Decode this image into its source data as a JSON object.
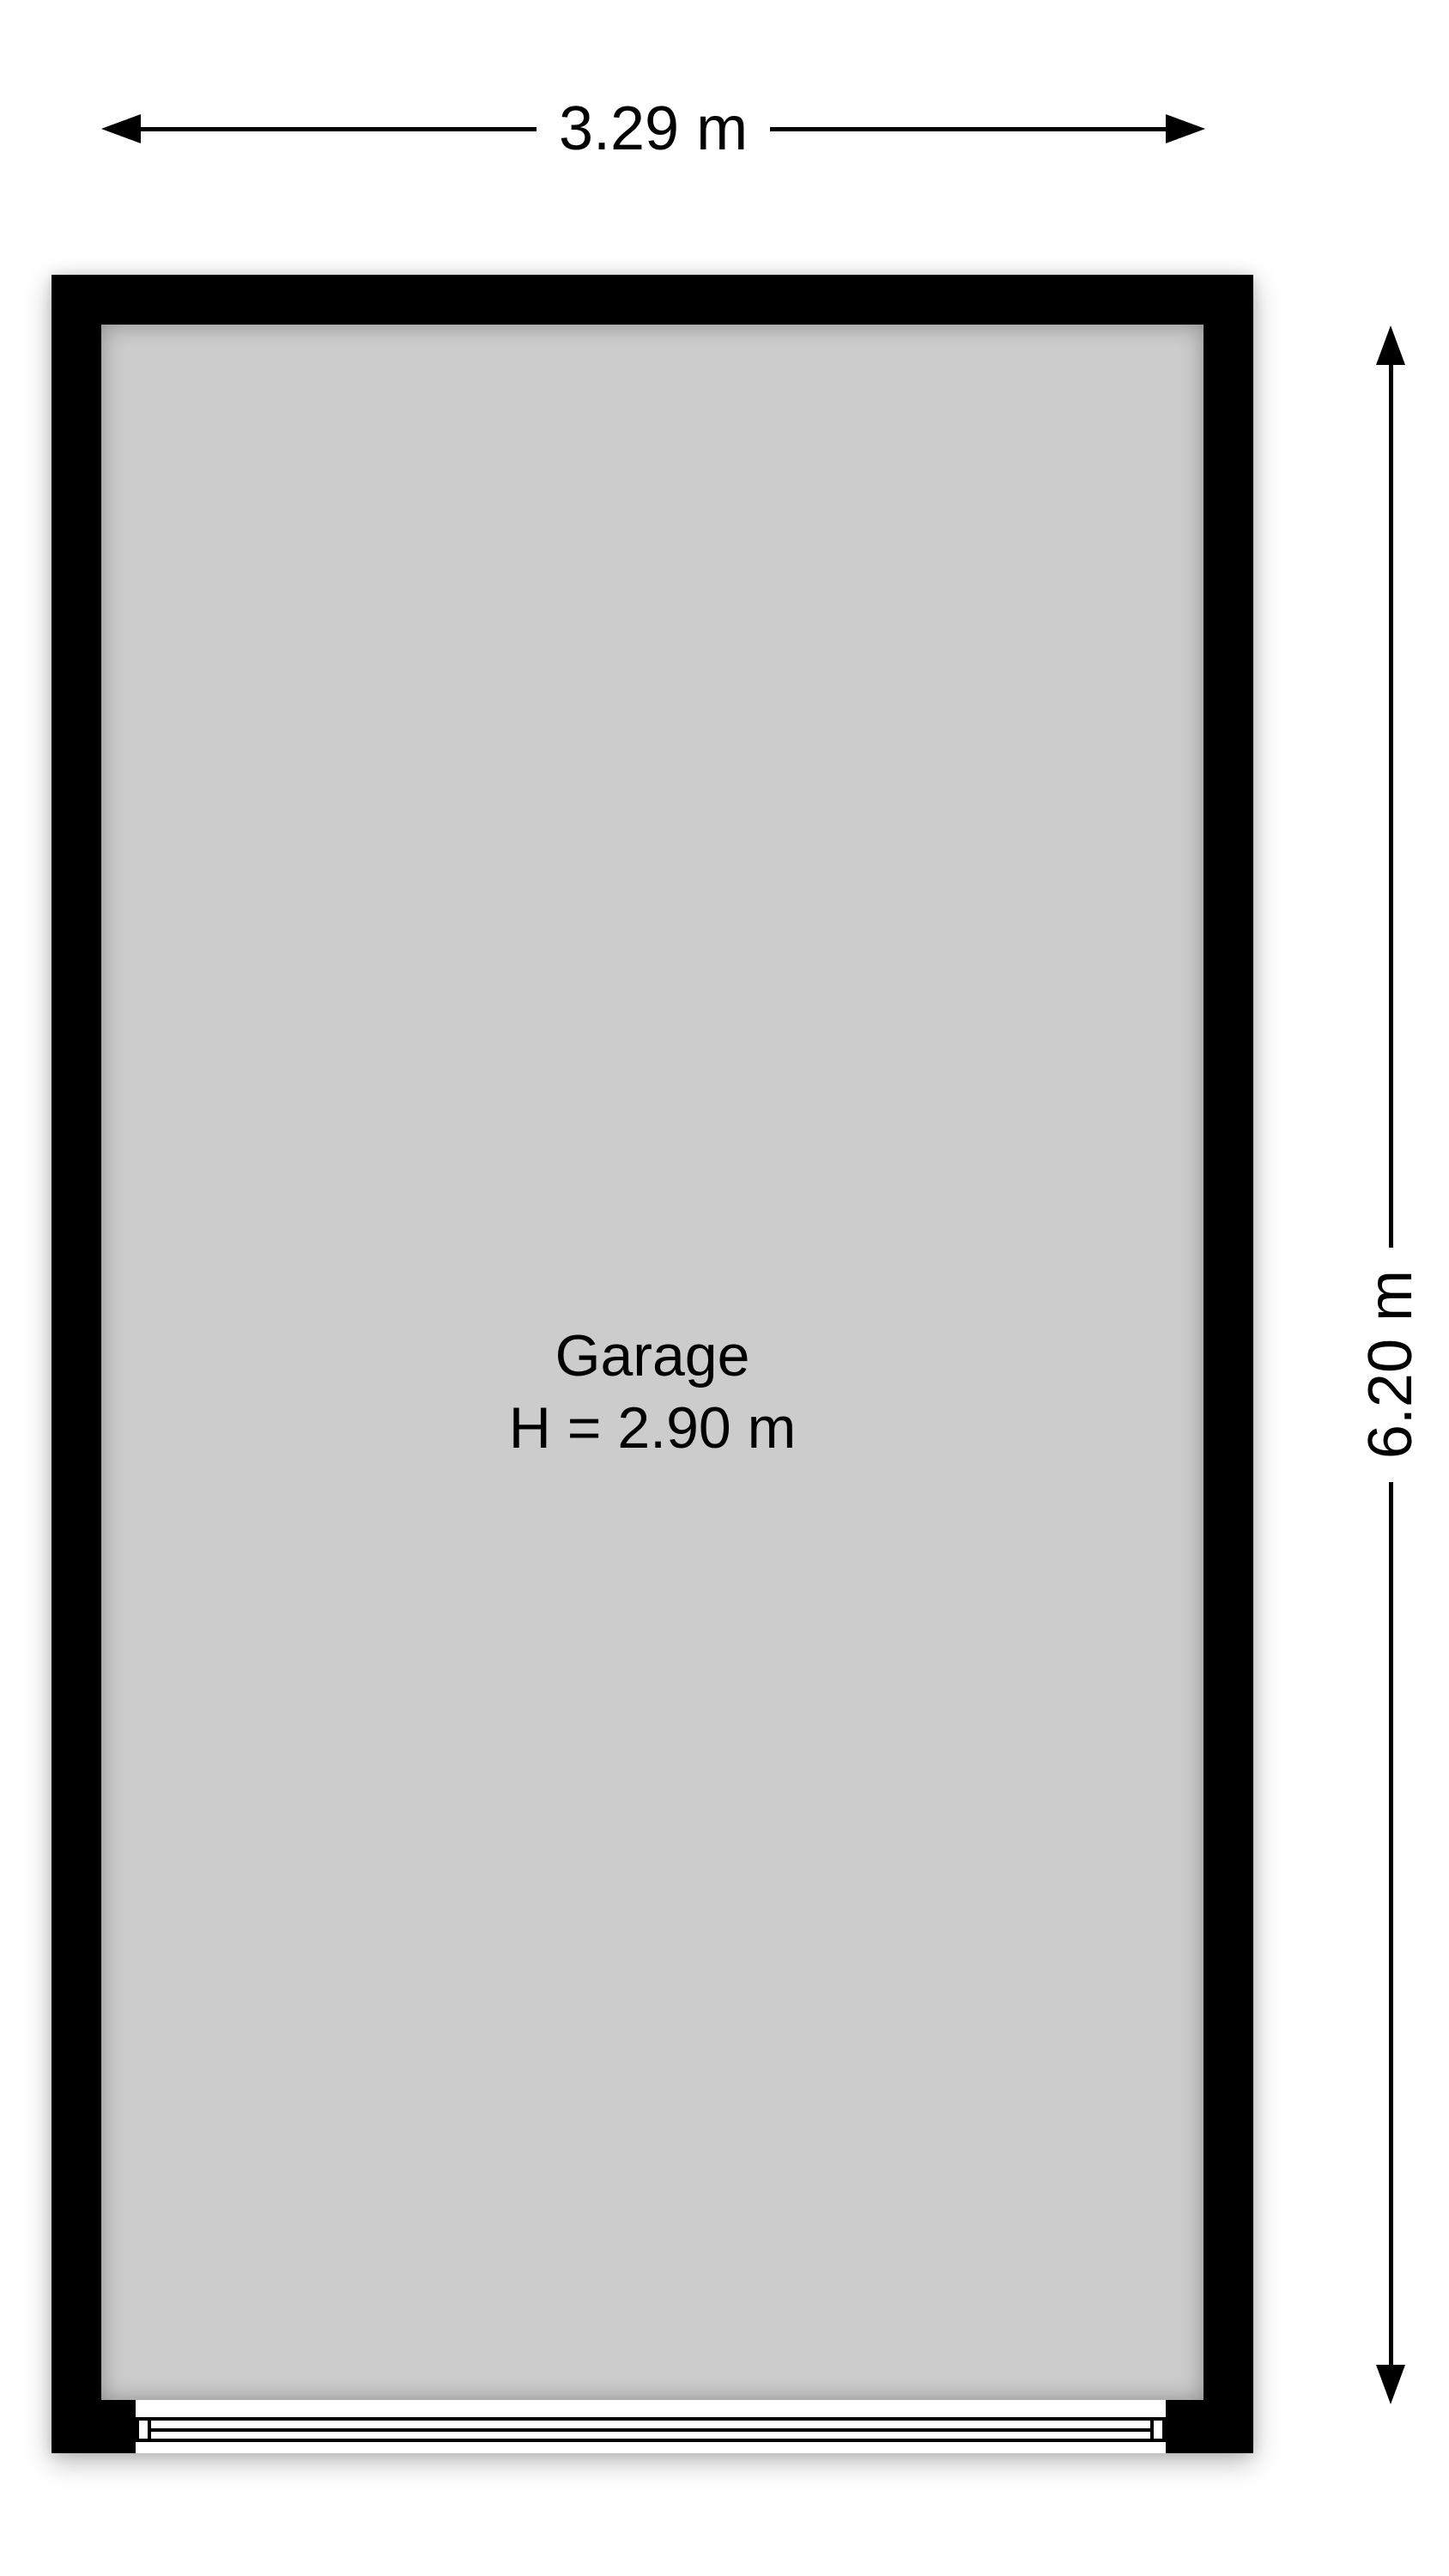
{
  "floorplan": {
    "room": {
      "name": "Garage",
      "height_label": "H = 2.90 m"
    },
    "dimensions": {
      "width": {
        "label": "3.29 m"
      },
      "height": {
        "label": "6.20 m"
      }
    },
    "colors": {
      "wall": "#000000",
      "floor": "#cccccc",
      "dimension_line": "#000000",
      "background": "#ffffff"
    },
    "icons": {
      "width_dimension": "double-headed-horizontal-arrow",
      "height_dimension": "double-headed-vertical-arrow"
    }
  }
}
